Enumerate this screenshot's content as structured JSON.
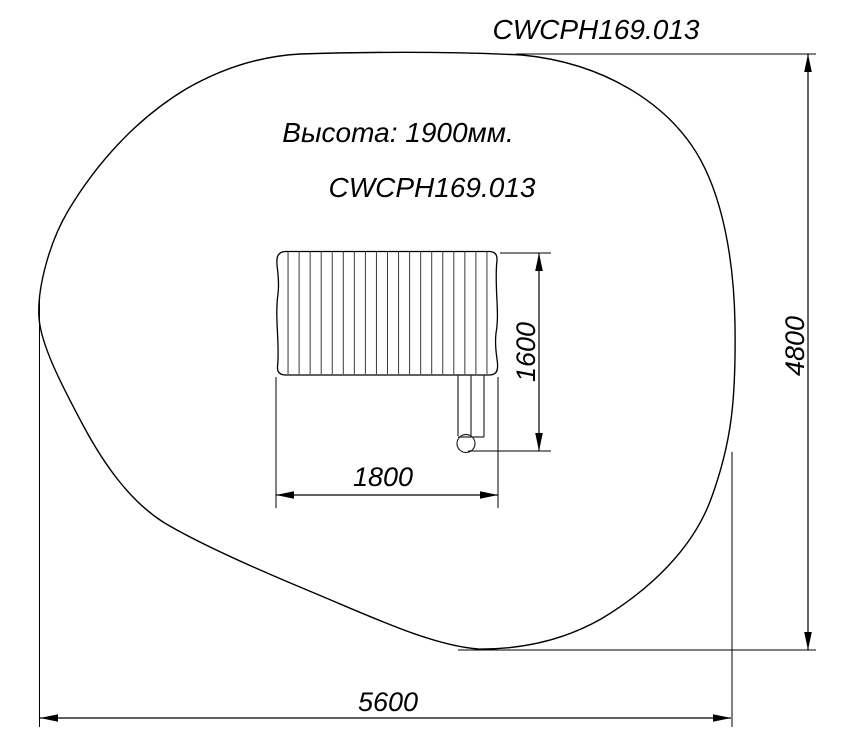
{
  "drawing": {
    "code_top": "CWCPH169.013",
    "height_note": "Высота: 1900мм.",
    "code_center": "CWCPH169.013",
    "dims": {
      "overall_width": "5600",
      "overall_depth": "4800",
      "equipment_width": "1800",
      "equipment_depth": "1600"
    },
    "equipment": {
      "slat_count": 20
    },
    "colors": {
      "line": "#000000",
      "background": "#ffffff"
    }
  }
}
